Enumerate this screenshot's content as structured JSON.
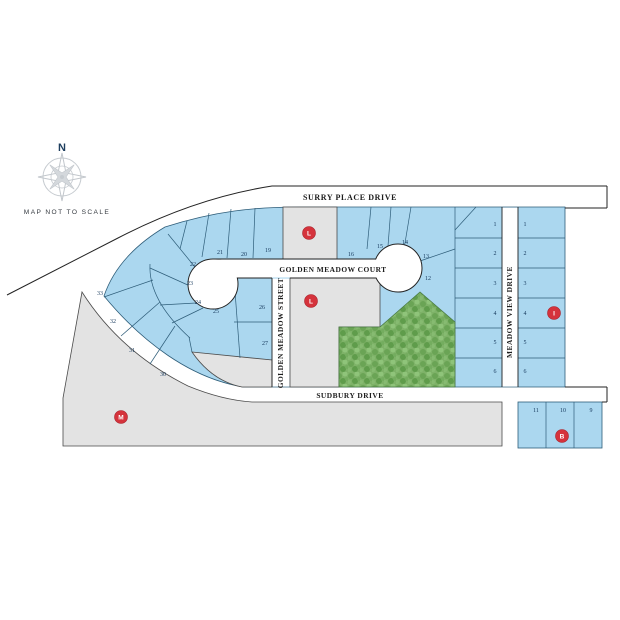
{
  "map": {
    "compass_north": "N",
    "scale_note": "MAP NOT TO SCALE",
    "streets": {
      "surry_place": "SURRY PLACE DRIVE",
      "golden_meadow_court": "GOLDEN MEADOW COURT",
      "golden_meadow_street": "GOLDEN MEADOW STREET",
      "meadow_view": "MEADOW VIEW DRIVE",
      "sudbury": "SUDBURY DRIVE"
    },
    "markers": [
      {
        "label": "L"
      },
      {
        "label": "L"
      },
      {
        "label": "M"
      },
      {
        "label": "I"
      },
      {
        "label": "B"
      }
    ],
    "lots": {
      "north_row": [
        "21",
        "20",
        "19",
        "16",
        "15",
        "14",
        "13",
        "12"
      ],
      "court_inner": [
        "22",
        "23",
        "24",
        "25"
      ],
      "west_arc": [
        "33",
        "32",
        "31",
        "30"
      ],
      "street_side": [
        "26",
        "27"
      ],
      "meadow_view_west": [
        "1",
        "2",
        "3",
        "4",
        "5",
        "6"
      ],
      "meadow_view_east": [
        "1",
        "2",
        "3",
        "4",
        "5",
        "6"
      ],
      "south_block": [
        "11",
        "10",
        "9"
      ]
    },
    "colors": {
      "available_lot": "#abd7ef",
      "reserved_area": "#e3e3e3",
      "greenspace": "#7eb268",
      "marker": "#d5333c",
      "road": "#ffffff",
      "number_text": "#16395c"
    }
  }
}
